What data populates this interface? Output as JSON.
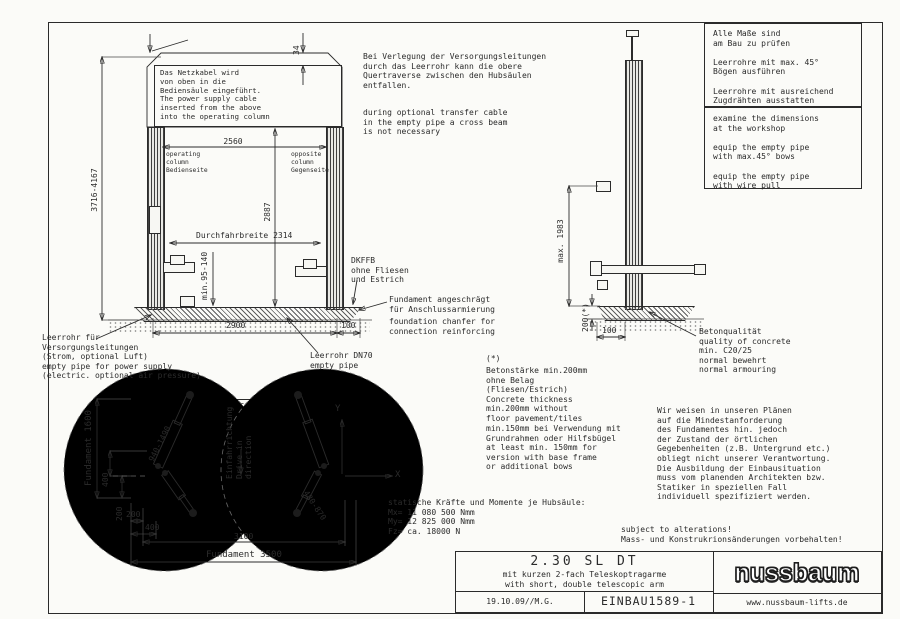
{
  "colors": {
    "ink": "#2b2b2b",
    "paper": "#fbfbf8"
  },
  "front": {
    "netzkabel": "Das Netzkabel wird\nvon oben in die\nBediensäule eingeführt.\nThe power supply cable\ninserted from the above\ninto the operating column",
    "dim_total": "3716-4167",
    "dim_34": "34",
    "dim_2560": "2560",
    "col_left": "operating\ncolumn\nBedienseite",
    "col_right": "opposite\ncolumn\nGegenseite",
    "dim_2887": "2887",
    "durchfahrbreite": "Durchfahrbreite 2314",
    "dim_min95": "min.95-140",
    "dim_2900": "2900",
    "dim_100": "100"
  },
  "side": {
    "dim_max1983": "max. 1983",
    "dim_200": "200(*)",
    "dim_100": "100"
  },
  "plan": {
    "fundament_w": "Fundament 1600",
    "fundament_l": "Fundament 3500",
    "dim_3100": "3100",
    "dim_400v": "400",
    "dim_200v": "200",
    "dim_200h": "200",
    "dim_400h": "400",
    "arm_long": "940-1490",
    "arm_short": "480-870",
    "drive": "Einfahrrichtung\nDrive in direction",
    "axis_x": "X",
    "axis_y": "Y"
  },
  "notes": {
    "verlegung_de": "Bei Verlegung der Versorgungsleitungen\ndurch das Leerrohr kann die obere\nQuertraverse zwischen den Hubsäulen\nentfallen.",
    "verlegung_en": "during optional transfer cable\nin the empty pipe a cross beam\nis not necessary",
    "pruefen_de": "Alle Maße sind\nam Bau zu prüfen\n\nLeerrohre mit max. 45°\nBögen ausführen\n\nLeerrohre mit ausreichend\nZugdrähten ausstatten",
    "pruefen_en": "examine the dimensions\nat the workshop\n\nequip the empty pipe\nwith max.45° bows\n\nequip the empty pipe\nwith wire pull",
    "dkffb": "DKFFB\nohne Fliesen\nund Estrich",
    "chamfer_de": "Fundament angeschrägt\nfür Anschlussarmierung",
    "chamfer_en": "foundation chanfer for\nconnection reinforcing",
    "leerrohr_links": "Leerrohr für\nVersorgungsleitungen\n(Strom, optional Luft)\nempty pipe for power supply\n(electric. optional air pressure)",
    "leerrohr_dn70": "Leerrohr DN70\nempty pipe",
    "beton": "Betonqualität\nquality of concrete\nmin. C20/25\nnormal bewehrt\nnormal armouring",
    "star": "(*)",
    "betonstaerke": "Betonstärke min.200mm\nohne Belag\n(Fliesen/Estrich)\nConcrete thickness\nmin.200mm without\nfloor pavement/tiles",
    "betonstaerke2": "min.150mm bei Verwendung mit\nGrundrahmen oder Hilfsbügel\nat least min. 150mm for\nversion with base frame\nor additional bows",
    "plaene": "Wir weisen in unseren Plänen\nauf die Mindestanforderung\ndes Fundamentes hin.  jedoch\nder Zustand der örtlichen\nGegebenheiten (z.B. Untergrund etc.)\nobliegt nicht unserer Verantwortung.\nDie Ausbildung der Einbausituation\nmuss vom planenden Architekten bzw.\nStatiker in speziellen Fall\nindividuell spezifiziert werden."
  },
  "statics": "statische Kräfte und Momente je Hubsäule:\nMx= 11 080 500 Nmm\nMy= 12 825 000 Nmm\nFz= ca. 18000 N",
  "alterations": "subject to alterations!\nMass- und Konstrukrionsänderungen vorbehalten!",
  "title_block": {
    "model": "2.30 SL DT",
    "subtitle_de": "mit kurzen 2-fach Teleskoptragarme",
    "subtitle_en": "with short, double telescopic arm",
    "date_author": "19.10.09//M.G.",
    "drawing_number": "EINBAU1589-1",
    "brand": "nussbaum",
    "website": "www.nussbaum-lifts.de"
  }
}
